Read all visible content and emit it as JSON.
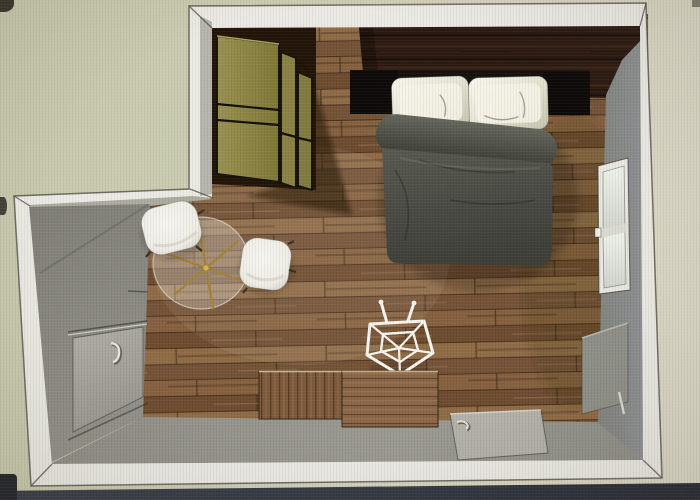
{
  "scene": {
    "type": "3d-room-render-top-view",
    "description": "Top-down 3D rendering of a bedroom floor plan",
    "furniture": [
      {
        "id": "wardrobe",
        "label": "Olive wardrobe cabinets"
      },
      {
        "id": "bed",
        "label": "Double bed with dark duvet and two silver pillows"
      },
      {
        "id": "glass-table",
        "label": "Round glass table with brass star base"
      },
      {
        "id": "chair-1",
        "label": "White chair"
      },
      {
        "id": "chair-2",
        "label": "White chair"
      },
      {
        "id": "wire-stool",
        "label": "White geometric wire stool"
      },
      {
        "id": "sideboard",
        "label": "Two-part wooden sideboard"
      },
      {
        "id": "door-left",
        "label": "Door on left wall"
      },
      {
        "id": "door-bottom",
        "label": "Door on bottom wall"
      },
      {
        "id": "window-right",
        "label": "Window on right wall"
      },
      {
        "id": "wall-panel-right",
        "label": "Recessed panel on right wall"
      }
    ]
  },
  "colors": {
    "exterior_left": "#c8caad",
    "exterior_right": "#dbd8c7",
    "wall_band": "#ebeae4",
    "notch_strip": "#adaca0",
    "wall_left_face": "#83827a",
    "wall_bottom_face": "#98978f",
    "wall_right_face": "#87898b",
    "walnut_wall": "#2e1c13",
    "wardrobe_olive": "#8d8545",
    "wardrobe_shadow": "#221407",
    "floor_base": "#7e5c3c",
    "headboard": "#16110d",
    "duvet": "#4c4d45",
    "pillow": "#eceadb",
    "chair": "#f1f0ea",
    "stool_wire": "#f7f6f0",
    "table_glass": "rgba(232,233,225,0.30)",
    "table_base_gold": "#a5823a",
    "sideboard_left": "#7d5a3b",
    "sideboard_right": "#8b6647",
    "door_panel": "#a8a79f",
    "window_frame": "#e9e8e2",
    "bezel": "#343944"
  }
}
